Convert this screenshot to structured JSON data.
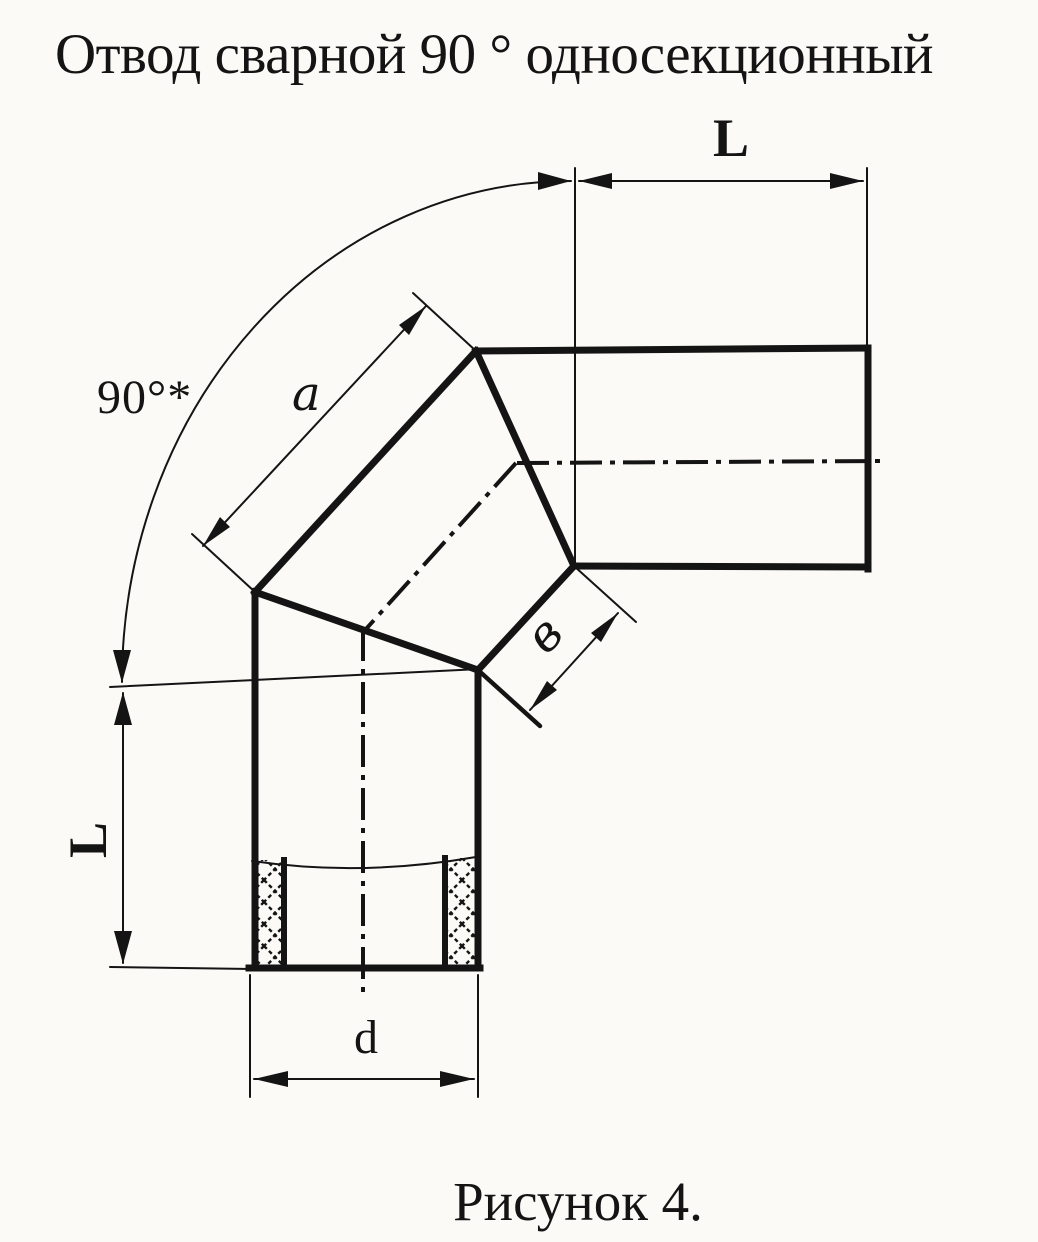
{
  "title": "Отвод сварной 90 ° односекционный",
  "caption": "Рисунок 4.",
  "labels": {
    "angle": "90°*",
    "length_top": "L",
    "length_left": "L",
    "segment_outer": "a",
    "segment_inner": "в",
    "diameter": "d"
  },
  "colors": {
    "ink": "#141414",
    "paper": "#fbfaf7"
  }
}
